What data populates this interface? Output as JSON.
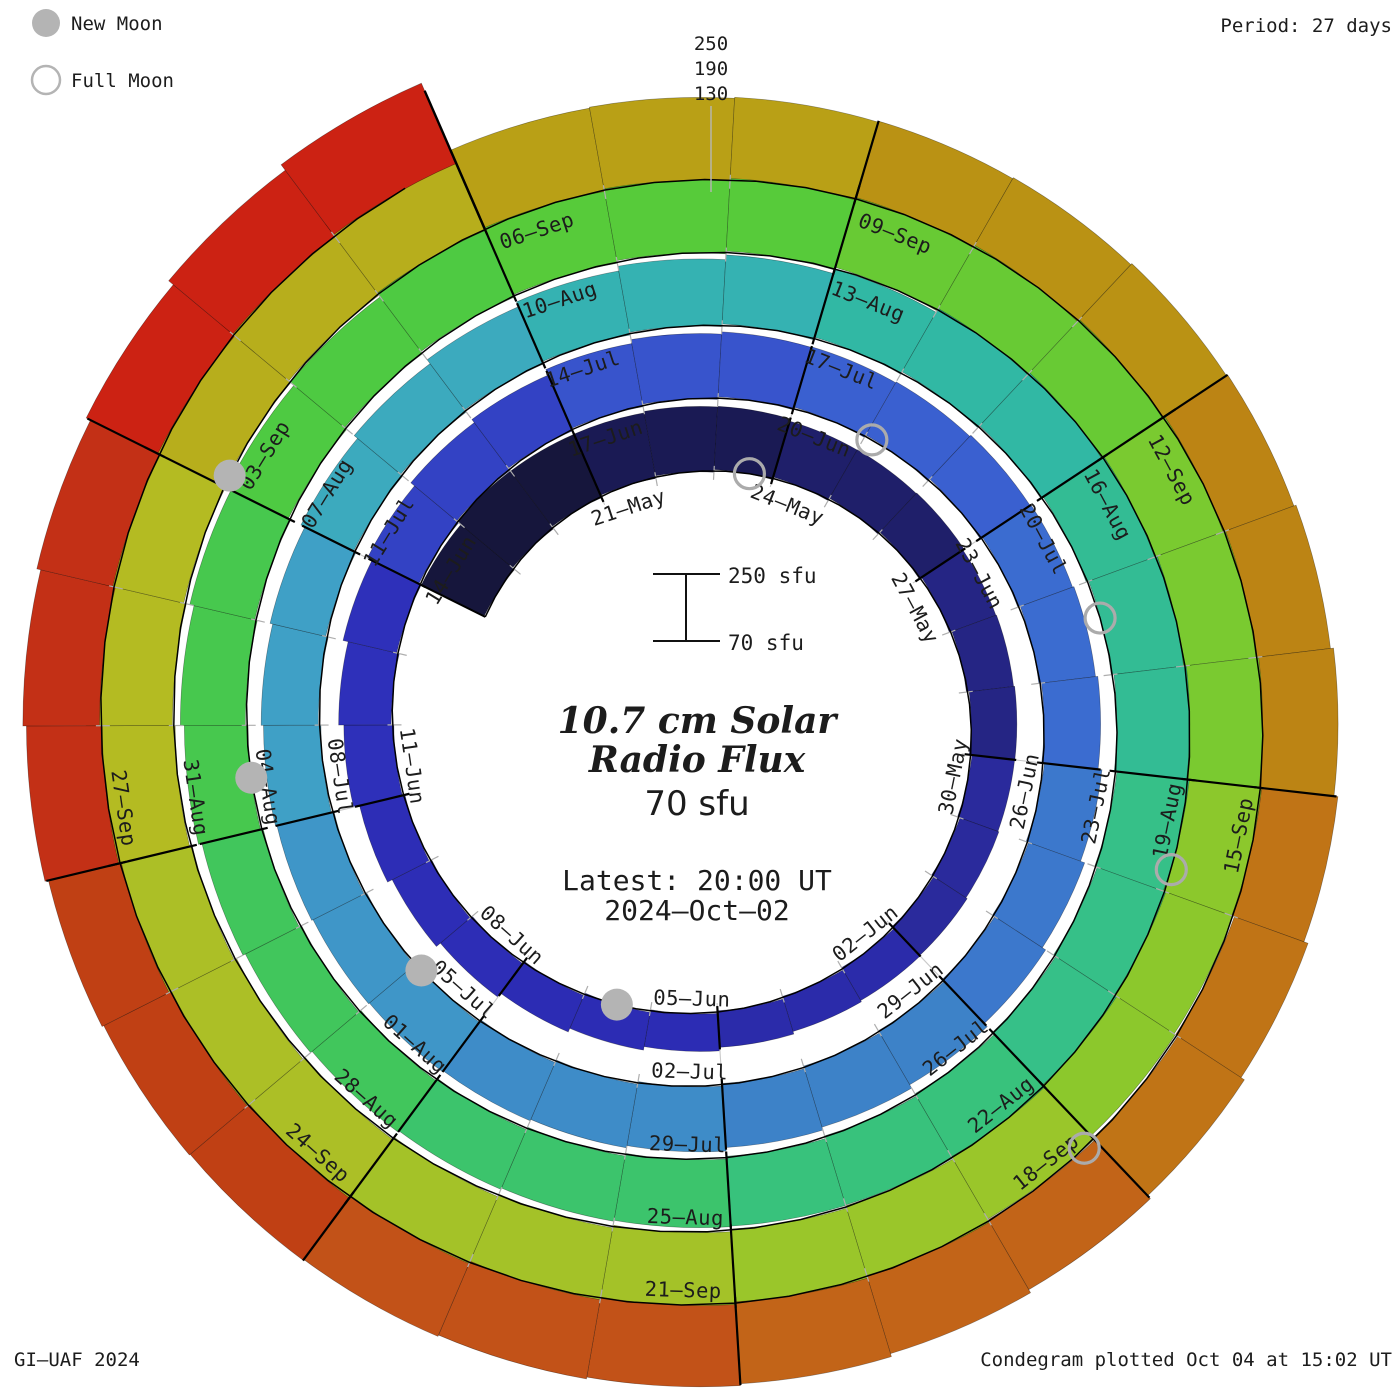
{
  "legend": {
    "new_moon": "New Moon",
    "full_moon": "Full Moon",
    "marker_color": "#b4b4b4"
  },
  "header": {
    "period": "Period: 27 days"
  },
  "footer": {
    "left": "GI–UAF 2024",
    "right": "Condegram plotted Oct 04 at 15:02 UT"
  },
  "radial_scale": {
    "labels": [
      "250",
      "190",
      "130"
    ]
  },
  "center": {
    "scale_top": "250 sfu",
    "scale_bottom": "70 sfu",
    "title_line1": "10.7 cm Solar",
    "title_line2": "Radio Flux",
    "current_flux": "70 sfu",
    "latest_line1": "Latest: 20:00 UT",
    "latest_line2": "2024–Oct–02",
    "accent_color": "#ef3a34"
  },
  "chart_data": {
    "type": "spiral-bar-condegram",
    "title": "10.7 cm Solar Radio Flux",
    "start_date": "2024-05-18",
    "end_date": "2024-10-02",
    "period_days": 27,
    "flux_base": 70,
    "flux_gridlines": [
      130,
      190,
      250
    ],
    "label_step_days": 3,
    "first_label_day_offset": 3,
    "date_labels": [
      "21–May",
      "24–May",
      "27–May",
      "30–May",
      "02–Jun",
      "05–Jun",
      "08–Jun",
      "11–Jun",
      "14–Jun",
      "17–Jun",
      "20–Jun",
      "23–Jun",
      "26–Jun",
      "29–Jun",
      "02–Jul",
      "05–Jul",
      "08–Jul",
      "11–Jul",
      "14–Jul",
      "17–Jul",
      "20–Jul",
      "23–Jul",
      "26–Jul",
      "29–Jul",
      "01–Aug",
      "04–Aug",
      "07–Aug",
      "10–Aug",
      "13–Aug",
      "16–Aug",
      "19–Aug",
      "22–Aug",
      "25–Aug",
      "28–Aug",
      "31–Aug",
      "03–Sep",
      "06–Sep",
      "09–Sep",
      "12–Sep",
      "15–Sep",
      "18–Sep",
      "21–Sep",
      "24–Sep",
      "27–Sep"
    ],
    "daily_flux": [
      238,
      243,
      236,
      230,
      227,
      222,
      210,
      204,
      199,
      189,
      184,
      180,
      173,
      169,
      166,
      161,
      158,
      158,
      160,
      162,
      165,
      170,
      176,
      182,
      190,
      196,
      202,
      208,
      213,
      216,
      224,
      227,
      226,
      221,
      217,
      214,
      210,
      207,
      206,
      209,
      213,
      216,
      220,
      223,
      224,
      226,
      225,
      222,
      218,
      214,
      211,
      208,
      207,
      207,
      211,
      215,
      220,
      226,
      231,
      236,
      241,
      246,
      251,
      258,
      263,
      266,
      262,
      258,
      253,
      248,
      243,
      238,
      233,
      229,
      226,
      223,
      221,
      221,
      223,
      226,
      230,
      235,
      240,
      245,
      258,
      266,
      272,
      278,
      281,
      279,
      266,
      259,
      252,
      245,
      241,
      238,
      243,
      248,
      253,
      256,
      260,
      263,
      266,
      269,
      271,
      274,
      277,
      279,
      283,
      281,
      277,
      273,
      269,
      265,
      261,
      257,
      254,
      251,
      250,
      251,
      254,
      258,
      261,
      264,
      266,
      267,
      265,
      263,
      260,
      256,
      252,
      250,
      252,
      254,
      257,
      262,
      270,
      280
    ],
    "block_colors": [
      "#16163c",
      "#1a1a54",
      "#1f1f6a",
      "#252584",
      "#2a2a9c",
      "#2b2baa",
      "#2c2cb4",
      "#2d2db6",
      "#2e30ba",
      "#3342c4",
      "#3854cc",
      "#3a60d0",
      "#3b6cd0",
      "#3c78cc",
      "#3d82c8",
      "#3e8cc8",
      "#3f96c8",
      "#3fa0c6",
      "#3caabe",
      "#35b2b2",
      "#31b8a4",
      "#33bc94",
      "#36c088",
      "#38c27c",
      "#3cc46c",
      "#41c65c",
      "#47c84e",
      "#4eca42",
      "#57cb3a",
      "#68ca34",
      "#7aca30",
      "#8cc82c",
      "#9ac62a",
      "#a4c228",
      "#acbf26",
      "#b4bb22",
      "#b7ae1c",
      "#b9a016",
      "#ba9214",
      "#bc8414",
      "#c07416",
      "#c26418",
      "#c25218",
      "#c04014",
      "#c33016",
      "#cc2213"
    ],
    "moons": {
      "full_days": [
        5.6,
        34.1,
        64.4,
        93.8,
        123.1
      ],
      "new_days": [
        19.5,
        48.9,
        78.5,
        108.1
      ]
    },
    "geometry": {
      "cx": 700,
      "cy": 724,
      "r_base": 240,
      "r_per_day": 2.7,
      "theta0": 153.5,
      "px_per_sfu": 0.4167,
      "grid_extra_days": 26,
      "grid_color": "#b6b6b6",
      "spoke_color": "#c9c9c9",
      "divider_color": "#000000",
      "label_color": "#222222"
    }
  }
}
